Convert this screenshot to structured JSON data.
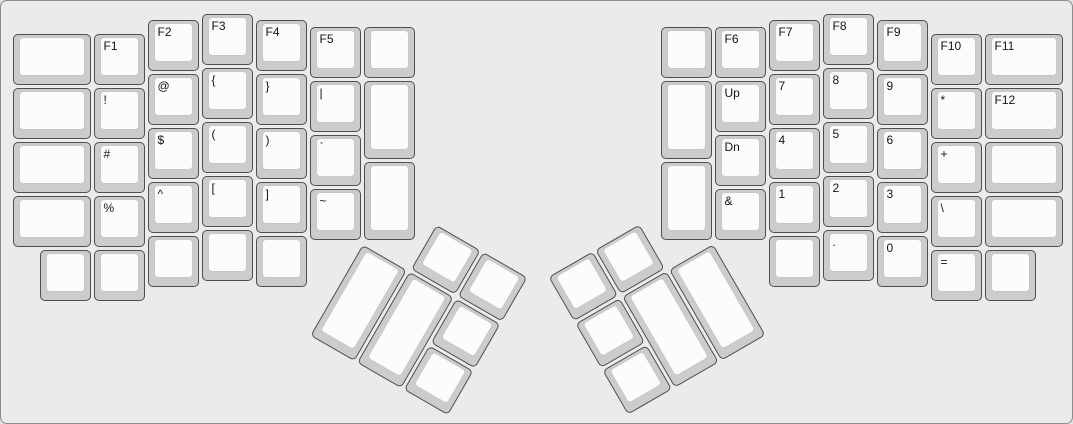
{
  "app": {
    "description": "ErgoDox split keyboard layout render, function and symbol layer"
  },
  "canvas": {
    "width": 1073,
    "height": 424,
    "background": "#ebebeb",
    "border_color": "#8c8c8c"
  },
  "key_style": {
    "unit": 54,
    "cap_inset": 1.5,
    "cap_color": "#cccccc",
    "cap_border_color": "#4f4f4f",
    "top_color": "#fcfcfc",
    "top_border_color": "#c8c8c8",
    "label_color": "#141414"
  },
  "origin": {
    "x": 10,
    "y": 11
  },
  "main_keys": [
    {
      "name": "key-blank",
      "label": "",
      "x": 0,
      "y": 0.375,
      "w": 1.5
    },
    {
      "name": "key-blank",
      "label": "",
      "x": 0,
      "y": 1.375,
      "w": 1.5
    },
    {
      "name": "key-blank",
      "label": "",
      "x": 0,
      "y": 2.375,
      "w": 1.5
    },
    {
      "name": "key-blank",
      "label": "",
      "x": 0,
      "y": 3.375,
      "w": 1.5
    },
    {
      "name": "key-f1",
      "label": "F1",
      "x": 1.5,
      "y": 0.375
    },
    {
      "name": "key-exclamation",
      "label": "!",
      "x": 1.5,
      "y": 1.375
    },
    {
      "name": "key-hash",
      "label": "#",
      "x": 1.5,
      "y": 2.375
    },
    {
      "name": "key-percent",
      "label": "%",
      "x": 1.5,
      "y": 3.375
    },
    {
      "name": "key-f2",
      "label": "F2",
      "x": 2.5,
      "y": 0.125
    },
    {
      "name": "key-at",
      "label": "@",
      "x": 2.5,
      "y": 1.125
    },
    {
      "name": "key-dollar",
      "label": "$",
      "x": 2.5,
      "y": 2.125
    },
    {
      "name": "key-caret",
      "label": "^",
      "x": 2.5,
      "y": 3.125
    },
    {
      "name": "key-f3",
      "label": "F3",
      "x": 3.5,
      "y": 0
    },
    {
      "name": "key-open-brace",
      "label": "{",
      "x": 3.5,
      "y": 1
    },
    {
      "name": "key-open-paren",
      "label": "(",
      "x": 3.5,
      "y": 2
    },
    {
      "name": "key-open-bracket",
      "label": "[",
      "x": 3.5,
      "y": 3
    },
    {
      "name": "key-f4",
      "label": "F4",
      "x": 4.5,
      "y": 0.125
    },
    {
      "name": "key-close-brace",
      "label": "}",
      "x": 4.5,
      "y": 1.125
    },
    {
      "name": "key-close-paren",
      "label": ")",
      "x": 4.5,
      "y": 2.125
    },
    {
      "name": "key-close-bracket",
      "label": "]",
      "x": 4.5,
      "y": 3.125
    },
    {
      "name": "key-f5",
      "label": "F5",
      "x": 5.5,
      "y": 0.25
    },
    {
      "name": "key-pipe",
      "label": "|",
      "x": 5.5,
      "y": 1.25
    },
    {
      "name": "key-backtick",
      "label": "`",
      "x": 5.5,
      "y": 2.25
    },
    {
      "name": "key-tilde",
      "label": "~",
      "x": 5.5,
      "y": 3.25
    },
    {
      "name": "key-blank",
      "label": "",
      "x": 6.5,
      "y": 0.25
    },
    {
      "name": "key-blank",
      "label": "",
      "x": 6.5,
      "y": 1.25,
      "h": 1.5
    },
    {
      "name": "key-blank",
      "label": "",
      "x": 6.5,
      "y": 2.75,
      "h": 1.5
    },
    {
      "name": "key-blank",
      "label": "",
      "x": 0.5,
      "y": 4.375
    },
    {
      "name": "key-blank",
      "label": "",
      "x": 1.5,
      "y": 4.375
    },
    {
      "name": "key-blank",
      "label": "",
      "x": 2.5,
      "y": 4.125
    },
    {
      "name": "key-blank",
      "label": "",
      "x": 3.5,
      "y": 4
    },
    {
      "name": "key-blank",
      "label": "",
      "x": 4.5,
      "y": 4.125
    },
    {
      "name": "key-blank",
      "label": "",
      "x": 12,
      "y": 0.25
    },
    {
      "name": "key-blank",
      "label": "",
      "x": 12,
      "y": 1.25,
      "h": 1.5
    },
    {
      "name": "key-blank",
      "label": "",
      "x": 12,
      "y": 2.75,
      "h": 1.5
    },
    {
      "name": "key-f6",
      "label": "F6",
      "x": 13,
      "y": 0.25
    },
    {
      "name": "key-up",
      "label": "Up",
      "x": 13,
      "y": 1.25
    },
    {
      "name": "key-dn",
      "label": "Dn",
      "x": 13,
      "y": 2.25
    },
    {
      "name": "key-ampersand",
      "label": "&",
      "x": 13,
      "y": 3.25
    },
    {
      "name": "key-f7",
      "label": "F7",
      "x": 14,
      "y": 0.125
    },
    {
      "name": "key-7",
      "label": "7",
      "x": 14,
      "y": 1.125
    },
    {
      "name": "key-4",
      "label": "4",
      "x": 14,
      "y": 2.125
    },
    {
      "name": "key-1",
      "label": "1",
      "x": 14,
      "y": 3.125
    },
    {
      "name": "key-f8",
      "label": "F8",
      "x": 15,
      "y": 0
    },
    {
      "name": "key-8",
      "label": "8",
      "x": 15,
      "y": 1
    },
    {
      "name": "key-5",
      "label": "5",
      "x": 15,
      "y": 2
    },
    {
      "name": "key-2",
      "label": "2",
      "x": 15,
      "y": 3
    },
    {
      "name": "key-f9",
      "label": "F9",
      "x": 16,
      "y": 0.125
    },
    {
      "name": "key-9",
      "label": "9",
      "x": 16,
      "y": 1.125
    },
    {
      "name": "key-6",
      "label": "6",
      "x": 16,
      "y": 2.125
    },
    {
      "name": "key-3",
      "label": "3",
      "x": 16,
      "y": 3.125
    },
    {
      "name": "key-f10",
      "label": "F10",
      "x": 17,
      "y": 0.375
    },
    {
      "name": "key-asterisk",
      "label": "*",
      "x": 17,
      "y": 1.375
    },
    {
      "name": "key-plus",
      "label": "+",
      "x": 17,
      "y": 2.375
    },
    {
      "name": "key-backslash",
      "label": "\\",
      "x": 17,
      "y": 3.375
    },
    {
      "name": "key-f11",
      "label": "F11",
      "x": 18,
      "y": 0.375,
      "w": 1.5
    },
    {
      "name": "key-f12",
      "label": "F12",
      "x": 18,
      "y": 1.375,
      "w": 1.5
    },
    {
      "name": "key-blank",
      "label": "",
      "x": 18,
      "y": 2.375,
      "w": 1.5
    },
    {
      "name": "key-blank",
      "label": "",
      "x": 18,
      "y": 3.375,
      "w": 1.5
    },
    {
      "name": "key-blank",
      "label": "",
      "x": 14,
      "y": 4.125
    },
    {
      "name": "key-period",
      "label": ".",
      "x": 15,
      "y": 4
    },
    {
      "name": "key-0",
      "label": "0",
      "x": 16,
      "y": 4.125
    },
    {
      "name": "key-equals",
      "label": "=",
      "x": 17,
      "y": 4.375
    },
    {
      "name": "key-blank",
      "label": "",
      "x": 18,
      "y": 4.375
    }
  ],
  "thumb_clusters": [
    {
      "name": "left-thumb-cluster",
      "origin": {
        "x": 6.5,
        "y": 4.25
      },
      "rotation": 30,
      "keys": [
        {
          "name": "key-blank",
          "label": "",
          "x": 1,
          "y": -1
        },
        {
          "name": "key-blank",
          "label": "",
          "x": 2,
          "y": -1
        },
        {
          "name": "key-blank",
          "label": "",
          "x": 0,
          "y": 0,
          "h": 2
        },
        {
          "name": "key-blank",
          "label": "",
          "x": 1,
          "y": 0,
          "h": 2
        },
        {
          "name": "key-blank",
          "label": "",
          "x": 2,
          "y": 0
        },
        {
          "name": "key-blank",
          "label": "",
          "x": 2,
          "y": 1
        }
      ]
    },
    {
      "name": "right-thumb-cluster",
      "origin": {
        "x": 13,
        "y": 4.25
      },
      "rotation": -30,
      "keys": [
        {
          "name": "key-blank",
          "label": "",
          "x": -3,
          "y": -1
        },
        {
          "name": "key-blank",
          "label": "",
          "x": -2,
          "y": -1
        },
        {
          "name": "key-blank",
          "label": "",
          "x": -3,
          "y": 0
        },
        {
          "name": "key-blank",
          "label": "",
          "x": -2,
          "y": 0,
          "h": 2
        },
        {
          "name": "key-blank",
          "label": "",
          "x": -1,
          "y": 0,
          "h": 2
        },
        {
          "name": "key-blank",
          "label": "",
          "x": -3,
          "y": 1
        }
      ]
    }
  ]
}
